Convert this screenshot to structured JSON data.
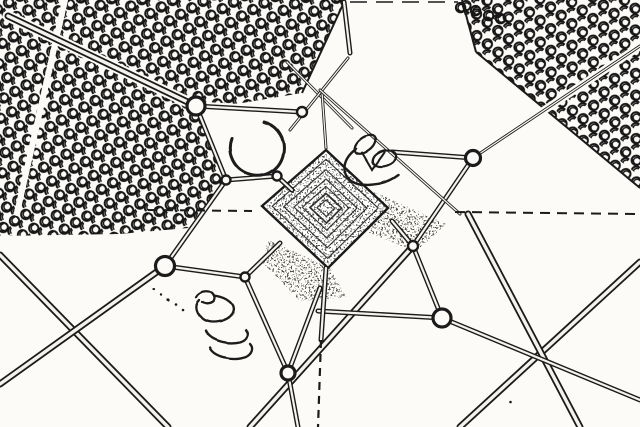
{
  "scene": {
    "title": "Edge-detected aerial photograph of a guyed lattice tower viewed from directly above, with tree plantations, guy-wire anchors and crossing dirt roads",
    "style": "black ink line-art on white paper (edge-detection filter)",
    "colors": {
      "ink": "#1b1b1b",
      "paper": "#fcfbf7",
      "road_core": "#f3f2ec"
    },
    "tower_core": {
      "cx": 326,
      "cy": 208,
      "corners": [
        [
          326,
          150
        ],
        [
          388,
          208
        ],
        [
          328,
          268
        ],
        [
          262,
          206
        ]
      ],
      "nested_scales": [
        0.84,
        0.66,
        0.5,
        0.37,
        0.25,
        0.14
      ]
    },
    "texture_patches": [
      "M370,190 L446,224 L416,252 L368,232 Z",
      "M268,240 L330,268 L346,297 L300,301 L262,262 Z"
    ],
    "tree_fields": [
      {
        "name": "upper-left-plantation",
        "pattern": "treesA",
        "d": "M0,0 L345,0 L302,93 L200,110 L226,180 L188,228 L120,234 L0,236 Z"
      },
      {
        "name": "upper-right-plantation",
        "pattern": "treesB",
        "d": "M460,0 L640,0 L640,188 L476,52 Z"
      }
    ],
    "extra_trees": [
      [
        470,
        5
      ],
      [
        483,
        10
      ],
      [
        455,
        2
      ],
      [
        495,
        13
      ]
    ],
    "field_boundaries": [
      [
        345,
        0,
        302,
        93
      ],
      [
        476,
        52,
        640,
        188
      ],
      [
        462,
        0,
        476,
        52
      ]
    ],
    "road_underlays": [
      [
        8,
        16,
        196,
        106,
        11
      ],
      [
        196,
        106,
        302,
        112,
        9
      ],
      [
        473,
        158,
        640,
        46,
        8
      ],
      [
        65,
        0,
        17,
        213,
        6
      ]
    ],
    "roads": [
      [
        8,
        16,
        196,
        106
      ],
      [
        0,
        255,
        168,
        427
      ],
      [
        0,
        384,
        165,
        266
      ],
      [
        460,
        427,
        640,
        262
      ],
      [
        468,
        214,
        580,
        427
      ],
      [
        413,
        246,
        250,
        427
      ]
    ],
    "wires": [
      [
        196,
        106,
        302,
        112
      ],
      [
        196,
        106,
        226,
        180
      ],
      [
        226,
        180,
        277,
        176
      ],
      [
        226,
        180,
        165,
        266
      ],
      [
        165,
        266,
        245,
        277
      ],
      [
        245,
        277,
        288,
        373
      ],
      [
        277,
        176,
        292,
        190
      ],
      [
        245,
        277,
        280,
        243
      ],
      [
        288,
        373,
        298,
        427
      ],
      [
        288,
        373,
        320,
        288
      ],
      [
        392,
        221,
        413,
        246
      ],
      [
        413,
        246,
        473,
        158
      ],
      [
        413,
        246,
        442,
        318
      ],
      [
        442,
        318,
        640,
        400
      ],
      [
        442,
        318,
        318,
        311
      ],
      [
        473,
        158,
        392,
        152
      ],
      [
        326,
        268,
        321,
        340
      ],
      [
        344,
        2,
        350,
        53
      ]
    ],
    "thin_wires": [
      [
        473,
        158,
        640,
        46
      ],
      [
        287,
        62,
        352,
        128
      ],
      [
        348,
        58,
        290,
        130
      ],
      [
        322,
        92,
        326,
        148
      ],
      [
        320,
        90,
        460,
        214
      ]
    ],
    "dashed_lines": [
      {
        "x1": 148,
        "y1": 210,
        "x2": 252,
        "y2": 211,
        "w": 2,
        "dash": "9 7"
      },
      {
        "x1": 455,
        "y1": 212,
        "x2": 640,
        "y2": 214,
        "w": 2,
        "dash": "10 7"
      },
      {
        "x1": 350,
        "y1": 2,
        "x2": 458,
        "y2": 2,
        "w": 1.5,
        "dash": "17 9"
      },
      {
        "x1": 321,
        "y1": 340,
        "x2": 318,
        "y2": 427,
        "w": 2.2,
        "dash": "8 6"
      }
    ],
    "anchors": [
      {
        "x": 196,
        "y": 106,
        "r": 9
      },
      {
        "x": 473,
        "y": 158,
        "r": 7.5
      },
      {
        "x": 165,
        "y": 266,
        "r": 9.5
      },
      {
        "x": 442,
        "y": 318,
        "r": 9
      },
      {
        "x": 288,
        "y": 373,
        "r": 7
      }
    ],
    "junctions": [
      {
        "x": 226,
        "y": 180,
        "r": 4.5
      },
      {
        "x": 277,
        "y": 176,
        "r": 4.5
      },
      {
        "x": 245,
        "y": 277,
        "r": 4.5
      },
      {
        "x": 413,
        "y": 246,
        "r": 5
      },
      {
        "x": 302,
        "y": 112,
        "r": 5
      }
    ],
    "arcs": [
      {
        "d": "M 264 122 A 27 27 0 1 1 232 139",
        "w": 3
      },
      {
        "d": "M 356 149 a 25 16 -18 1 0 42 26",
        "w": 2.4
      },
      {
        "d": "M 362 153 L 372 170 L 384 153",
        "w": 2
      }
    ],
    "loops": [
      {
        "cx": 365,
        "cy": 145,
        "rx": 12,
        "ry": 7,
        "rot": -38
      },
      {
        "cx": 384,
        "cy": 159,
        "rx": 12,
        "ry": 7.5,
        "rot": -18
      }
    ],
    "scribbles": [
      {
        "d": "M196,297 C200,290 212,289 215,296 C218,303 207,306 202,302",
        "w": 2.3
      },
      {
        "d": "M215,296 C228,298 238,305 233,314 C228,322 212,325 204,320 C196,315 193,306 199,300",
        "w": 2.3
      },
      {
        "d": "M206,331 C210,340 226,345 240,342 C247,340 250,334 246,330",
        "w": 2.3
      },
      {
        "d": "M210,348 C214,357 232,362 246,357 C252,354 254,348 250,344",
        "w": 2.3
      }
    ],
    "dots": [
      [
        168,
        299,
        1.6
      ],
      [
        176,
        304,
        1.3
      ],
      [
        161,
        294,
        1.2
      ],
      [
        183,
        310,
        1.3
      ],
      [
        154,
        289,
        1.1
      ],
      [
        510,
        403,
        1.3
      ]
    ]
  }
}
